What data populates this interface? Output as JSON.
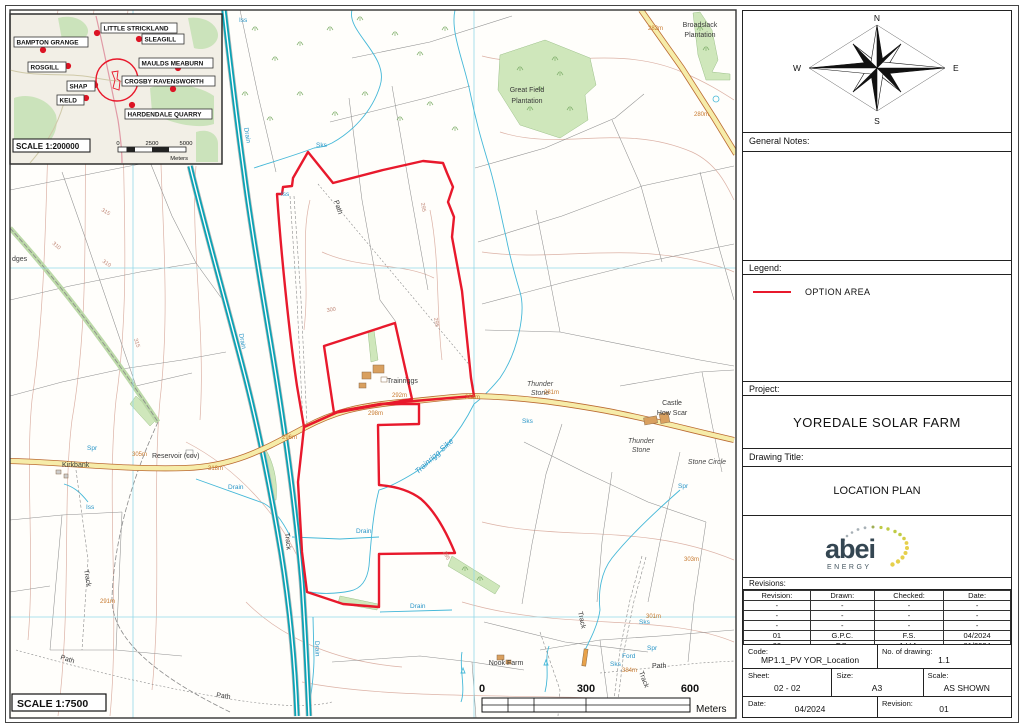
{
  "colors": {
    "option_area": "#e8192c",
    "motorway": "#0aa3b5",
    "road_fill": "#f6eca9",
    "road_casing": "#bb6b33",
    "water": "#45b8d8",
    "grid": "#93d8e8",
    "woodland": "#cfe7bb",
    "spot_height": "#c7792e"
  },
  "inset": {
    "places": [
      "LITTLE STRICKLAND",
      "SLEAGILL",
      "BAMPTON GRANGE",
      "MAULDS MEABURN",
      "ROSGILL",
      "CROSBY RAVENSWORTH",
      "SHAP",
      "KELD",
      "HARDENDALE QUARRY"
    ],
    "scale_label": "SCALE 1:200000",
    "scalebar": {
      "t0": "0",
      "t1": "2500",
      "t2": "5000",
      "unit": "Meters"
    }
  },
  "map": {
    "labels": [
      "Broadslack",
      "Plantation",
      "Great Field",
      "Plantation",
      "Kirkbank",
      "Reservoir (cov)",
      "Trainriggs",
      "Thunder",
      "Stone",
      "Thunder",
      "Stone",
      "Castle",
      "How Scar",
      "Stone Circle",
      "Nook Farm",
      "Trainrigg Sike",
      "Path",
      "Path",
      "Path",
      "Path",
      "Track",
      "Track",
      "Track",
      "Track",
      "Drain",
      "Drain",
      "Drain",
      "Drain",
      "Drain",
      "Drain",
      "Sks",
      "Iss",
      "Sks",
      "Sks",
      "Spr",
      "Ford",
      "Sks",
      "Iss",
      "Iss",
      "Spr",
      "Spr",
      "dges"
    ],
    "spot_heights": [
      "291m",
      "292m",
      "284m",
      "281m",
      "298m",
      "296m",
      "305m",
      "318m",
      "282m",
      "280m",
      "303m",
      "301m",
      "384m"
    ],
    "contour_labels": [
      "310",
      "315",
      "310",
      "315",
      "300",
      "295",
      "295",
      "295"
    ],
    "scale_label": "SCALE 1:7500",
    "scalebar": {
      "t0": "0",
      "t1": "300",
      "t2": "600",
      "unit": "Meters"
    }
  },
  "titleblock": {
    "compass": {
      "n": "N",
      "e": "E",
      "s": "S",
      "w": "W"
    },
    "general_notes_label": "General Notes:",
    "legend_label": "Legend:",
    "legend_item": "OPTION AREA",
    "project_label": "Project:",
    "project_name": "YOREDALE SOLAR FARM",
    "drawing_title_label": "Drawing Title:",
    "drawing_title": "LOCATION PLAN",
    "logo": {
      "name": "abei",
      "sub": "ENERGY"
    },
    "revisions_label": "Revisions:",
    "revision_table": {
      "headers": [
        "Revision:",
        "Drawn:",
        "Checked:",
        "Date:"
      ],
      "rows": [
        [
          "-",
          "-",
          "-",
          "-"
        ],
        [
          "-",
          "-",
          "-",
          "-"
        ],
        [
          "-",
          "-",
          "-",
          "-"
        ],
        [
          "01",
          "G.P.C.",
          "F.S.",
          "04/2024"
        ],
        [
          "00",
          "F.S.",
          "A.V.A.",
          "01/2024"
        ]
      ]
    },
    "code_label": "Code:",
    "code_value": "MP1.1_PV YOR_Location",
    "drawing_no_label": "No. of drawing:",
    "drawing_no_value": "1.1",
    "sheet_label": "Sheet:",
    "sheet_value": "02 - 02",
    "size_label": "Size:",
    "size_value": "A3",
    "scale_label": "Scale:",
    "scale_value": "AS SHOWN",
    "date_label": "Date:",
    "date_value": "04/2024",
    "revision_label": "Revision:",
    "revision_value": "01"
  }
}
